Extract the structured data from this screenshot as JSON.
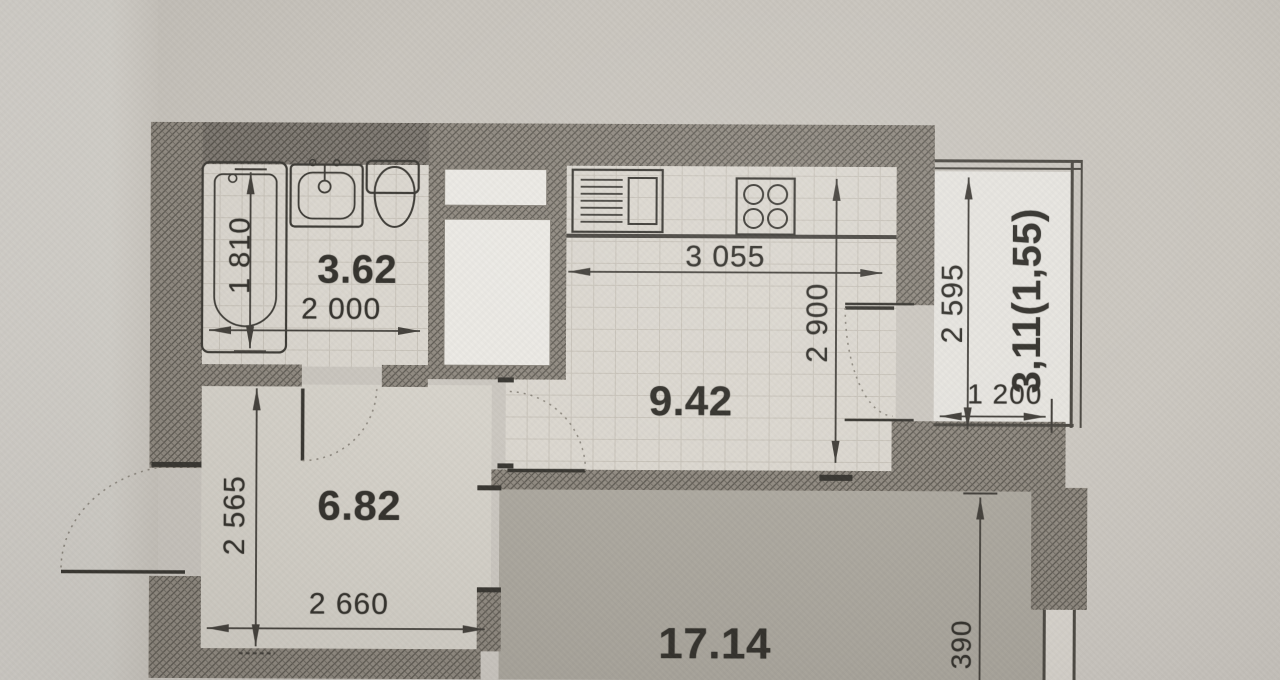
{
  "floorplan": {
    "rooms": [
      {
        "name": "bathroom",
        "area_label": "3.62"
      },
      {
        "name": "kitchen",
        "area_label": "9.42"
      },
      {
        "name": "hallway",
        "area_label": "6.82"
      },
      {
        "name": "living-room",
        "area_label": "17.14"
      },
      {
        "name": "balcony",
        "area_label": "3,11(1,55)"
      }
    ],
    "dimensions_mm": {
      "bathtub_length": "1 810",
      "bathroom_width": "2 000",
      "kitchen_width": "3 055",
      "kitchen_depth": "2 900",
      "balcony_length": "2 595",
      "balcony_width": "1 200",
      "hallway_depth": "2 565",
      "hallway_width": "2 660",
      "living_room_setback": "390"
    },
    "fixtures": [
      "bathtub",
      "wash-basin",
      "toilet",
      "kitchen-sink",
      "stove-4-burner"
    ],
    "colors": {
      "paper": "#cbc7c0",
      "paper_margin": "#d8d5cf",
      "wall_fill": "#938d84",
      "wall_hatch": "#5f5b54",
      "tile_floor": "#dcd8d0",
      "hall_floor": "#d8d4cc",
      "living_floor": "#aeaaa1",
      "balcony_floor": "#e7e5e0",
      "ink": "#36342f"
    }
  }
}
